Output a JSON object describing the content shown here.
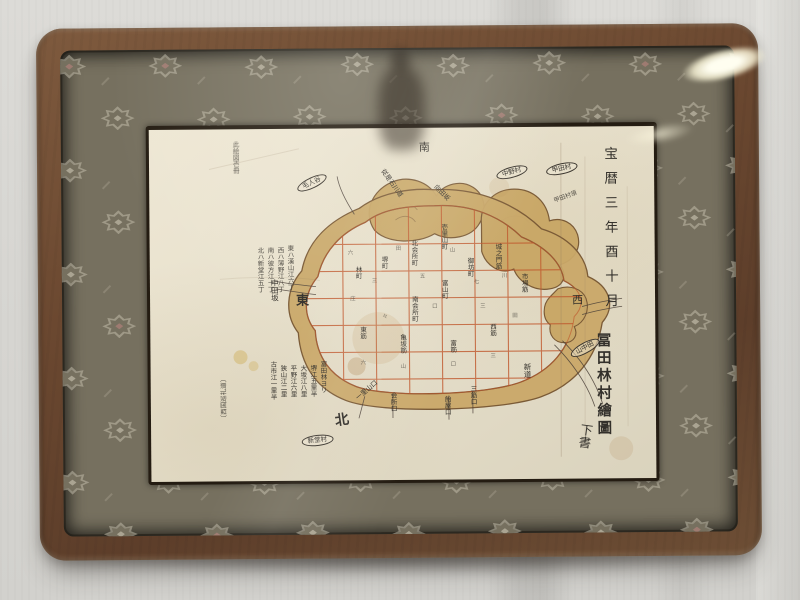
{
  "artifact": {
    "date_column": "宝暦三年酉十月",
    "title": "冨田林村繪圖",
    "draft_note": "下書"
  },
  "compass": {
    "east": "東",
    "west": "西",
    "south": "南",
    "north": "北"
  },
  "colors": {
    "wall": "#d6d5d1",
    "frame_wood": "#6b4830",
    "mat_fabric": "#76705f",
    "mat_motif": "#c8c1b0",
    "paper": "#e7e0cc",
    "moat_tan": "#c9a868",
    "moat_outline": "#7a5a36",
    "street_grid_red": "#c0572c",
    "ink": "#33302b"
  },
  "map": {
    "labels": [
      {
        "t": "中田坂",
        "x": 120,
        "y": 150,
        "s": 7.5,
        "k": "v"
      },
      {
        "t": "東ハ漢山江六丁",
        "x": 136,
        "y": 116,
        "s": 6.5,
        "k": "v",
        "o": 0.85
      },
      {
        "t": "西ハ薄野江八丁",
        "x": 126,
        "y": 118,
        "s": 6.5,
        "k": "v",
        "o": 0.85
      },
      {
        "t": "南ハ彼方江十丁",
        "x": 116,
        "y": 118,
        "s": 6.5,
        "k": "v",
        "o": 0.85
      },
      {
        "t": "北ハ新堂江五丁",
        "x": 106,
        "y": 118,
        "s": 6.5,
        "k": "v",
        "o": 0.85
      },
      {
        "t": "富田林ヨリ",
        "x": 168,
        "y": 232,
        "s": 6.5,
        "k": "v"
      },
      {
        "t": "堺江五里半",
        "x": 158,
        "y": 236,
        "s": 6.5,
        "k": "v"
      },
      {
        "t": "大坂江八里",
        "x": 148,
        "y": 236,
        "s": 6.5,
        "k": "v"
      },
      {
        "t": "平野江六里",
        "x": 138,
        "y": 236,
        "s": 6.5,
        "k": "v"
      },
      {
        "t": "狭山江二里",
        "x": 128,
        "y": 236,
        "s": 6.5,
        "k": "v"
      },
      {
        "t": "古市江一里半",
        "x": 118,
        "y": 232,
        "s": 6.5,
        "k": "v"
      },
      {
        "t": "〔西国巡礼道〕",
        "x": 70,
        "y": 292,
        "s": 6.5,
        "k": "d",
        "r": -90,
        "o": 0.8
      },
      {
        "t": "此絵図壱冊",
        "x": 82,
        "y": 12,
        "s": 6.5,
        "k": "v cursive"
      },
      {
        "t": "従是石川道",
        "x": 236,
        "y": 40,
        "s": 6.5,
        "k": "d",
        "r": 55
      },
      {
        "t": "向田坂",
        "x": 288,
        "y": 56,
        "s": 6.5,
        "k": "d",
        "r": 45
      },
      {
        "t": "甲田村領",
        "x": 404,
        "y": 72,
        "s": 6,
        "k": "d",
        "r": -20,
        "o": 0.8
      },
      {
        "t": "毛人谷",
        "x": 146,
        "y": 56,
        "s": 6.5,
        "k": "oval",
        "r": -25
      },
      {
        "t": "中野村",
        "x": 346,
        "y": 44,
        "s": 6.5,
        "k": "oval",
        "r": -15
      },
      {
        "t": "甲田村",
        "x": 396,
        "y": 40,
        "s": 6.5,
        "k": "oval",
        "r": -12
      },
      {
        "t": "新堂村",
        "x": 150,
        "y": 308,
        "s": 6.5,
        "k": "oval",
        "r": -6
      },
      {
        "t": "山中田",
        "x": 418,
        "y": 224,
        "s": 6.5,
        "k": "oval",
        "r": -28
      },
      {
        "t": "壱里山町",
        "x": 290,
        "y": 96,
        "s": 6.5,
        "k": "v"
      },
      {
        "t": "富山町",
        "x": 290,
        "y": 152,
        "s": 6.5,
        "k": "v"
      },
      {
        "t": "北会所町",
        "x": 260,
        "y": 112,
        "s": 6.5,
        "k": "v"
      },
      {
        "t": "南会所町",
        "x": 260,
        "y": 168,
        "s": 6.5,
        "k": "v"
      },
      {
        "t": "堺町",
        "x": 230,
        "y": 128,
        "s": 6.5,
        "k": "v"
      },
      {
        "t": "林町",
        "x": 204,
        "y": 138,
        "s": 6.5,
        "k": "v"
      },
      {
        "t": "御坊町",
        "x": 316,
        "y": 130,
        "s": 6.5,
        "k": "v"
      },
      {
        "t": "城之門筋",
        "x": 344,
        "y": 116,
        "s": 6.5,
        "k": "v"
      },
      {
        "t": "市場筋",
        "x": 370,
        "y": 146,
        "s": 6.5,
        "k": "v"
      },
      {
        "t": "東筋",
        "x": 208,
        "y": 198,
        "s": 6.5,
        "k": "v"
      },
      {
        "t": "西筋",
        "x": 338,
        "y": 196,
        "s": 6.5,
        "k": "v"
      },
      {
        "t": "亀坂筋",
        "x": 248,
        "y": 206,
        "s": 6.5,
        "k": "v"
      },
      {
        "t": "富筋",
        "x": 298,
        "y": 212,
        "s": 6.5,
        "k": "v"
      },
      {
        "t": "新道",
        "x": 372,
        "y": 236,
        "s": 7.5,
        "k": "v"
      },
      {
        "t": "一里山口",
        "x": 204,
        "y": 268,
        "s": 6.5,
        "k": "d",
        "r": -40
      },
      {
        "t": "会所口",
        "x": 238,
        "y": 264,
        "s": 6.5,
        "k": "v"
      },
      {
        "t": "飴屋口",
        "x": 292,
        "y": 268,
        "s": 6.5,
        "k": "v"
      },
      {
        "t": "三筋口",
        "x": 318,
        "y": 258,
        "s": 6.5,
        "k": "v"
      },
      {
        "t": "六",
        "x": 198,
        "y": 122,
        "s": 5.5,
        "k": "mark"
      },
      {
        "t": "三",
        "x": 222,
        "y": 150,
        "s": 5.5,
        "k": "mark"
      },
      {
        "t": "田",
        "x": 246,
        "y": 118,
        "s": 5.5,
        "k": "mark"
      },
      {
        "t": "五",
        "x": 270,
        "y": 146,
        "s": 5.5,
        "k": "mark"
      },
      {
        "t": "山",
        "x": 300,
        "y": 120,
        "s": 5.5,
        "k": "mark"
      },
      {
        "t": "七",
        "x": 324,
        "y": 152,
        "s": 5.5,
        "k": "mark"
      },
      {
        "t": "川",
        "x": 352,
        "y": 146,
        "s": 5.5,
        "k": "mark"
      },
      {
        "t": "庄",
        "x": 200,
        "y": 168,
        "s": 5.5,
        "k": "mark"
      },
      {
        "t": "々",
        "x": 232,
        "y": 186,
        "s": 5.5,
        "k": "mark"
      },
      {
        "t": "口",
        "x": 282,
        "y": 176,
        "s": 5.5,
        "k": "mark"
      },
      {
        "t": "三",
        "x": 330,
        "y": 176,
        "s": 5.5,
        "k": "mark"
      },
      {
        "t": "田",
        "x": 362,
        "y": 186,
        "s": 5.5,
        "k": "mark"
      },
      {
        "t": "六",
        "x": 210,
        "y": 232,
        "s": 5.5,
        "k": "mark"
      },
      {
        "t": "山",
        "x": 250,
        "y": 236,
        "s": 5.5,
        "k": "mark"
      },
      {
        "t": "口",
        "x": 300,
        "y": 234,
        "s": 5.5,
        "k": "mark"
      },
      {
        "t": "三",
        "x": 340,
        "y": 226,
        "s": 5.5,
        "k": "mark"
      }
    ]
  }
}
